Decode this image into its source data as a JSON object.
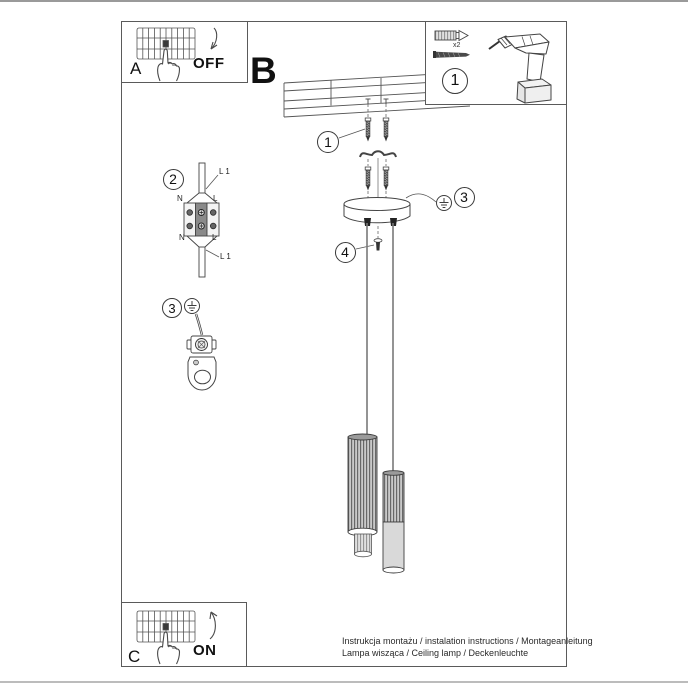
{
  "sections": {
    "a_label": "A",
    "b_label": "B",
    "c_label": "C",
    "off_label": "OFF",
    "on_label": "ON"
  },
  "tools": {
    "step_number": "1",
    "anchor_quantity": "x2"
  },
  "steps": {
    "screws": "1",
    "wiring": "2",
    "ground_left": "3",
    "ground_right": "3",
    "canopy_screw": "4"
  },
  "wiring_labels": {
    "line_top": "L 1",
    "live_top": "L",
    "neutral_top": "N",
    "live_bottom": "L",
    "neutral_bottom": "N",
    "line_bottom": "L 1"
  },
  "footer": {
    "line1": "Instrukcja montażu / instalation instructions / Montageanleitung",
    "line2": "Lampa wisząca / Ceiling lamp / Deckenleuchte"
  }
}
